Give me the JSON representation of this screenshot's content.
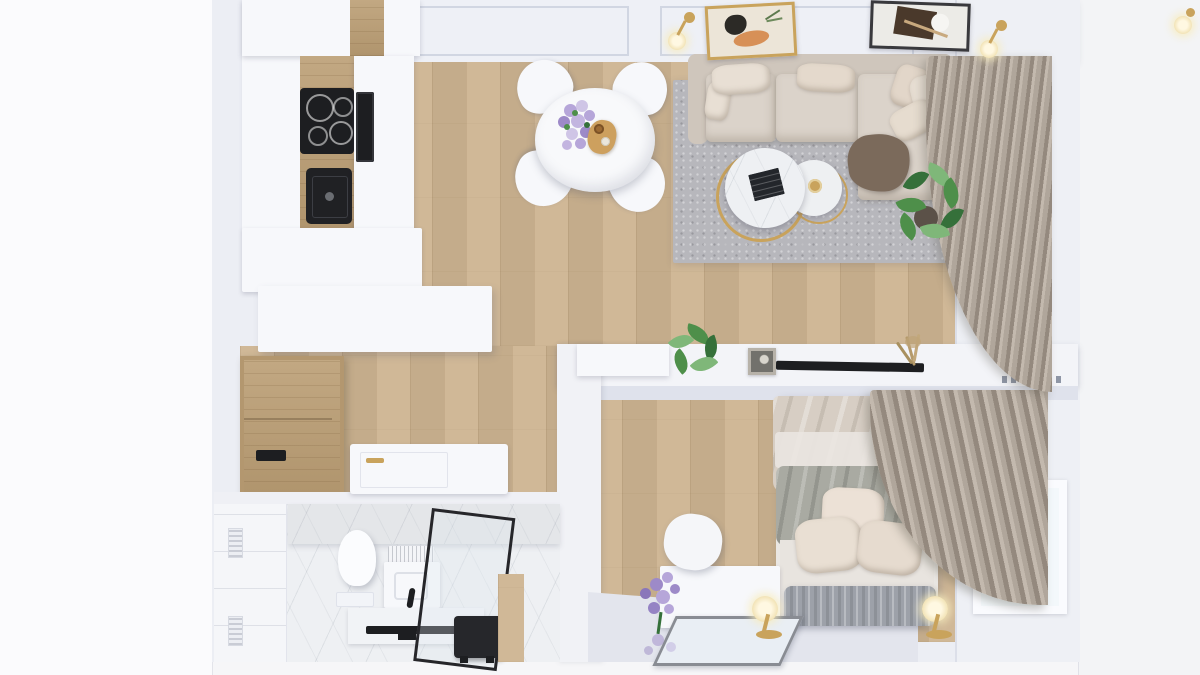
{
  "scene": {
    "title": "3D top-down render of a small one-bedroom apartment",
    "view": "bird's-eye floor plan render",
    "style": "scandinavian, white walls, oak floor, gold accents",
    "text_visible": "none"
  },
  "colors": {
    "outside": "#f6f6f8",
    "outside_left": "#fbfbfd",
    "wall": "#eceef4",
    "wall_face": "#dfe2ec",
    "ceiling": "#eef0f6",
    "wood": "#cdb491",
    "wood_dark": "#bb9e74",
    "rug": "#b7b7bc",
    "sofa": "#dbd3ca",
    "sofa_back": "#cfc6bc",
    "pillow": "#e8dfd4",
    "throw": "#7b6a5b",
    "curtain": "#b0a69b",
    "curtain_hi": "#c3b9ae",
    "curtain_sh": "#94897e",
    "furniture_white": "#f7f8fb",
    "black": "#1d1e21",
    "gold": "#c9a35c",
    "plant": "#4e8f4a",
    "plant_light": "#7fb779",
    "plant_dark": "#35703a",
    "flower_purple": "#9d8ac8",
    "flower_lilac": "#b6a6d9",
    "marble": "#eef0f3",
    "tile": "#f5f6f9",
    "duvet": "#d7cec4",
    "blanket": "#a9aaa2",
    "bench": "#9da1a9",
    "mirror": "#e9eef4",
    "art_orange": "#d79057",
    "art_dark_brown": "#4a392b",
    "glass": "#dfe8ef"
  },
  "rooms": {
    "kitchen": {
      "name": "Kitchen",
      "objects": [
        "white cabinets",
        "oak worktop",
        "induction cooktop with 4 burners",
        "black undermount sink",
        "built-in oven",
        "white peninsula island"
      ]
    },
    "dining": {
      "name": "Dining area",
      "objects": [
        "round white table",
        "4 white shell chairs",
        "purple flower bouquet",
        "wooden serving board with bottle and glass"
      ],
      "chair_count": 4
    },
    "living": {
      "name": "Living room",
      "objects": [
        "beige L-shaped sectional sofa",
        "6 throw pillows",
        "brown throw blanket",
        "gray speckled rug",
        "2 round nesting coffee tables with gold frames",
        "dark magazine",
        "gold trinket dish",
        "monstera plant",
        "2 framed abstract artworks",
        "2 brass ceiling lamps",
        "window",
        "draped taupe curtain"
      ],
      "pillow_count": 6,
      "coffee_table_count": 2,
      "artwork_count": 2,
      "lamp_count": 2
    },
    "hallway": {
      "name": "Hallway",
      "objects": [
        "oak wardrobe with black handle",
        "white entrance door with gold handle"
      ]
    },
    "bathroom": {
      "name": "Bathroom",
      "objects": [
        "marble floor and walls",
        "white tiled wall with 2 vents",
        "wall-hung toilet",
        "washbasin unit with black faucet",
        "glass shower screen with black frame",
        "black towel rail",
        "black laundry stool"
      ],
      "vent_count": 2
    },
    "bedroom": {
      "name": "Bedroom",
      "objects": [
        "double bed with beige duvet and sage blanket",
        "3 beige pillows",
        "ribbed gray bench",
        "white vanity desk",
        "leaning mirror",
        "lavender bouquet",
        "white pouf chair",
        "2 brass table lamps",
        "window",
        "draped taupe curtain",
        "low TV console wall",
        "flat TV",
        "calathea plant",
        "photo frame",
        "dried grass decor",
        "radiator grille"
      ],
      "pillow_count": 3,
      "lamp_count": 2
    }
  }
}
